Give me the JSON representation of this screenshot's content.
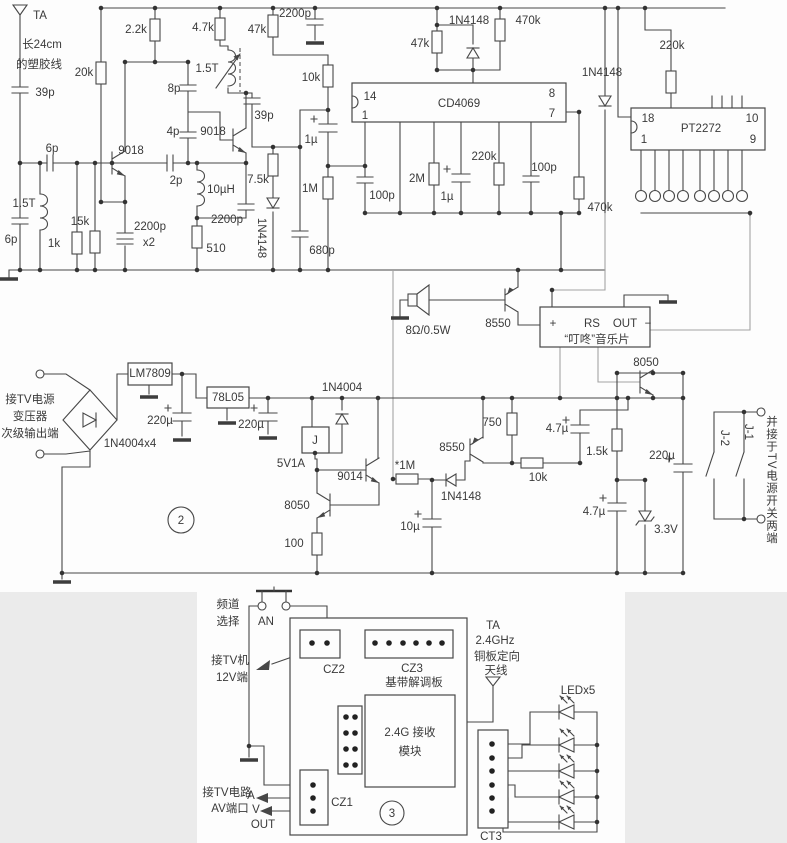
{
  "meta": {
    "accent_line_color": "#474747",
    "light_wire_color": "#a3a3a3",
    "background": "#fdfdfd"
  },
  "sections": {
    "power_section_number": "2",
    "receiver_board_number": "3"
  },
  "labels": [
    {
      "n": "antenna-ta-label",
      "t": "TA",
      "x": 40,
      "y": 16
    },
    {
      "n": "antenna-note-1",
      "t": "长24cm",
      "x": 42,
      "y": 45
    },
    {
      "n": "antenna-note-2",
      "t": "的塑胶线",
      "x": 39,
      "y": 65
    },
    {
      "n": "c-39p-1",
      "t": "39p",
      "x": 45,
      "y": 93
    },
    {
      "n": "c-6p-1",
      "t": "6p",
      "x": 52,
      "y": 149
    },
    {
      "n": "l-1t5-1",
      "t": "1.5T",
      "x": 24,
      "y": 204
    },
    {
      "n": "c-6p-2",
      "t": "6p",
      "x": 11,
      "y": 240,
      "s": 10.5
    },
    {
      "n": "r-1k",
      "t": "1k",
      "x": 54,
      "y": 244
    },
    {
      "n": "r-15k",
      "t": "15k",
      "x": 80,
      "y": 222
    },
    {
      "n": "r-20k",
      "t": "20k",
      "x": 84,
      "y": 73
    },
    {
      "n": "q-9018-1",
      "t": "9018",
      "x": 131,
      "y": 151
    },
    {
      "n": "r-2k2",
      "t": "2.2k",
      "x": 136,
      "y": 30
    },
    {
      "n": "c-2200p-x2",
      "t": "2200p",
      "x": 150,
      "y": 227
    },
    {
      "n": "c-2200p-x2b",
      "t": "x2",
      "x": 149,
      "y": 243
    },
    {
      "n": "c-2p",
      "t": "2p",
      "x": 176,
      "y": 181
    },
    {
      "n": "c-8p",
      "t": "8p",
      "x": 174,
      "y": 89
    },
    {
      "n": "c-4p",
      "t": "4p",
      "x": 173,
      "y": 132
    },
    {
      "n": "l-1t5-2",
      "t": "1.5T",
      "x": 207,
      "y": 69
    },
    {
      "n": "q-9018-2",
      "t": "9018",
      "x": 213,
      "y": 132
    },
    {
      "n": "c-39p-2",
      "t": "39p",
      "x": 264,
      "y": 116
    },
    {
      "n": "l-10uh",
      "t": "10µH",
      "x": 221,
      "y": 190
    },
    {
      "n": "c-2200p-2",
      "t": "2200p",
      "x": 227,
      "y": 220
    },
    {
      "n": "r-510",
      "t": "510",
      "x": 216,
      "y": 249
    },
    {
      "n": "r-7k5",
      "t": "7.5k",
      "x": 258,
      "y": 180
    },
    {
      "n": "d-1n4148-1",
      "t": "1N4148",
      "x": 261,
      "y": 238,
      "r": 90
    },
    {
      "n": "r-4k7",
      "t": "4.7k",
      "x": 203,
      "y": 28
    },
    {
      "n": "r-47k-1",
      "t": "47k",
      "x": 257,
      "y": 30
    },
    {
      "n": "c-2200p-top",
      "t": "2200p",
      "x": 295,
      "y": 14
    },
    {
      "n": "r-10k-1",
      "t": "10k",
      "x": 311,
      "y": 78
    },
    {
      "n": "c-1u-1",
      "t": "1µ",
      "x": 311,
      "y": 140
    },
    {
      "n": "r-1m",
      "t": "1M",
      "x": 310,
      "y": 189
    },
    {
      "n": "c-680p",
      "t": "680p",
      "x": 322,
      "y": 251
    },
    {
      "n": "pin-14",
      "t": "14",
      "x": 370,
      "y": 97,
      "s": 11
    },
    {
      "n": "pin-1",
      "t": "1",
      "x": 365,
      "y": 116,
      "s": 11
    },
    {
      "n": "ic-cd4069",
      "t": "CD4069",
      "x": 459,
      "y": 104
    },
    {
      "n": "pin-8",
      "t": "8",
      "x": 552,
      "y": 94,
      "s": 11
    },
    {
      "n": "pin-7",
      "t": "7",
      "x": 552,
      "y": 114,
      "s": 11
    },
    {
      "n": "r-47k-2",
      "t": "47k",
      "x": 420,
      "y": 44
    },
    {
      "n": "d-1n4148-2",
      "t": "1N4148",
      "x": 469,
      "y": 21
    },
    {
      "n": "r-470k-1",
      "t": "470k",
      "x": 528,
      "y": 21
    },
    {
      "n": "c-100p-1",
      "t": "100p",
      "x": 382,
      "y": 196
    },
    {
      "n": "r-2m",
      "t": "2M",
      "x": 417,
      "y": 179
    },
    {
      "n": "c-1u-2",
      "t": "1µ",
      "x": 447,
      "y": 197
    },
    {
      "n": "r-220k-1",
      "t": "220k",
      "x": 484,
      "y": 157
    },
    {
      "n": "c-100p-2",
      "t": "100p",
      "x": 544,
      "y": 168
    },
    {
      "n": "r-470k-2",
      "t": "470k",
      "x": 600,
      "y": 208
    },
    {
      "n": "d-1n4148-3",
      "t": "1N4148",
      "x": 602,
      "y": 73
    },
    {
      "n": "r-220k-2",
      "t": "220k",
      "x": 672,
      "y": 46
    },
    {
      "n": "pin-18",
      "t": "18",
      "x": 648,
      "y": 119,
      "s": 11
    },
    {
      "n": "pin-1b",
      "t": "1",
      "x": 644,
      "y": 140,
      "s": 11
    },
    {
      "n": "ic-pt2272",
      "t": "PT2272",
      "x": 701,
      "y": 129
    },
    {
      "n": "pin-10",
      "t": "10",
      "x": 752,
      "y": 119,
      "s": 11
    },
    {
      "n": "pin-9",
      "t": "9",
      "x": 753,
      "y": 140,
      "s": 11
    },
    {
      "n": "speaker-spec",
      "t": "8Ω/0.5W",
      "x": 428,
      "y": 331
    },
    {
      "n": "q-8550-mid",
      "t": "8550",
      "x": 498,
      "y": 324
    },
    {
      "n": "music-plus",
      "t": "+",
      "x": 553,
      "y": 324
    },
    {
      "n": "music-rs",
      "t": "RS",
      "x": 592,
      "y": 324
    },
    {
      "n": "music-out",
      "t": "OUT",
      "x": 625,
      "y": 324
    },
    {
      "n": "music-minus",
      "t": "−",
      "x": 648,
      "y": 324
    },
    {
      "n": "music-name",
      "t": "“叮咚”音乐片",
      "x": 597,
      "y": 340
    },
    {
      "n": "q-8050-right",
      "t": "8050",
      "x": 646,
      "y": 363
    },
    {
      "n": "tv-in-1",
      "t": "接TV电源",
      "x": 30,
      "y": 400
    },
    {
      "n": "tv-in-2",
      "t": "变压器",
      "x": 30,
      "y": 417
    },
    {
      "n": "tv-in-3",
      "t": "次级输出端",
      "x": 30,
      "y": 434
    },
    {
      "n": "d-bridge",
      "t": "1N4004x4",
      "x": 130,
      "y": 444
    },
    {
      "n": "ic-lm7809",
      "t": "LM7809",
      "x": 150,
      "y": 374
    },
    {
      "n": "c-220u-1",
      "t": "220µ",
      "x": 160,
      "y": 421
    },
    {
      "n": "ic-78l05",
      "t": "78L05",
      "x": 228,
      "y": 398
    },
    {
      "n": "c-220u-2",
      "t": "220µ",
      "x": 251,
      "y": 425
    },
    {
      "n": "d-1n4004",
      "t": "1N4004",
      "x": 342,
      "y": 388
    },
    {
      "n": "relay-j",
      "t": "J",
      "x": 315,
      "y": 441
    },
    {
      "n": "relay-spec",
      "t": "5V1A",
      "x": 291,
      "y": 464
    },
    {
      "n": "q-9014",
      "t": "9014",
      "x": 350,
      "y": 477
    },
    {
      "n": "r-1m-star",
      "t": "*1M",
      "x": 405,
      "y": 466
    },
    {
      "n": "q-8550-2",
      "t": "8550",
      "x": 452,
      "y": 448
    },
    {
      "n": "d-1n4148-4",
      "t": "1N4148",
      "x": 461,
      "y": 497
    },
    {
      "n": "r-750",
      "t": "750",
      "x": 492,
      "y": 423
    },
    {
      "n": "r-10k-2",
      "t": "10k",
      "x": 538,
      "y": 478
    },
    {
      "n": "c-4u7-1",
      "t": "4.7µ",
      "x": 557,
      "y": 429
    },
    {
      "n": "q-8050-left",
      "t": "8050",
      "x": 297,
      "y": 506
    },
    {
      "n": "r-100",
      "t": "100",
      "x": 294,
      "y": 544
    },
    {
      "n": "c-10u",
      "t": "10µ",
      "x": 410,
      "y": 527
    },
    {
      "n": "r-1k5",
      "t": "1.5k",
      "x": 597,
      "y": 452
    },
    {
      "n": "c-220u-3",
      "t": "220µ",
      "x": 662,
      "y": 456
    },
    {
      "n": "c-4u7-2",
      "t": "4.7µ",
      "x": 594,
      "y": 512
    },
    {
      "n": "d-zener",
      "t": "3.3V",
      "x": 666,
      "y": 530
    },
    {
      "n": "contact-j1",
      "t": "J-1",
      "x": 748,
      "y": 432,
      "r": 90
    },
    {
      "n": "contact-j2",
      "t": "J-2",
      "x": 724,
      "y": 438,
      "r": 90
    },
    {
      "n": "note-parallel-switch",
      "t": "并接于TV电源开关两端",
      "x": 771,
      "y": 480,
      "v": true
    },
    {
      "n": "section-2",
      "t": "2",
      "x": 181,
      "y": 521,
      "s": 15
    },
    {
      "n": "channel-1",
      "t": "频道",
      "x": 228,
      "y": 605
    },
    {
      "n": "channel-2",
      "t": "选择",
      "x": 228,
      "y": 622
    },
    {
      "n": "button-an",
      "t": "AN",
      "x": 266,
      "y": 622
    },
    {
      "n": "conn-cz2",
      "t": "CZ2",
      "x": 334,
      "y": 670
    },
    {
      "n": "conn-cz3",
      "t": "CZ3",
      "x": 412,
      "y": 669
    },
    {
      "n": "board-name",
      "t": "基带解调板",
      "x": 414,
      "y": 683
    },
    {
      "n": "tv12v-1",
      "t": "接TV机",
      "x": 230,
      "y": 661
    },
    {
      "n": "tv12v-2",
      "t": "12V端",
      "x": 232,
      "y": 678
    },
    {
      "n": "ant3-ta",
      "t": "TA",
      "x": 493,
      "y": 626
    },
    {
      "n": "ant3-freq",
      "t": "2.4GHz",
      "x": 495,
      "y": 641
    },
    {
      "n": "ant3-type",
      "t": "铜板定向",
      "x": 497,
      "y": 657
    },
    {
      "n": "ant3-name",
      "t": "天线",
      "x": 496,
      "y": 671
    },
    {
      "n": "module-1",
      "t": "2.4G 接收",
      "x": 410,
      "y": 733
    },
    {
      "n": "module-2",
      "t": "模块",
      "x": 410,
      "y": 752
    },
    {
      "n": "conn-cz1",
      "t": "CZ1",
      "x": 342,
      "y": 803
    },
    {
      "n": "av-1",
      "t": "接TV电路",
      "x": 227,
      "y": 793
    },
    {
      "n": "av-2",
      "t": "AV端口",
      "x": 230,
      "y": 809
    },
    {
      "n": "av-a",
      "t": "A",
      "x": 251,
      "y": 796,
      "s": 11
    },
    {
      "n": "av-v",
      "t": "V",
      "x": 256,
      "y": 810,
      "s": 11
    },
    {
      "n": "av-out",
      "t": "OUT",
      "x": 263,
      "y": 825,
      "s": 11
    },
    {
      "n": "section-3",
      "t": "3",
      "x": 392,
      "y": 814,
      "s": 15
    },
    {
      "n": "led-count",
      "t": "LEDx5",
      "x": 578,
      "y": 691
    },
    {
      "n": "conn-ct3",
      "t": "CT3",
      "x": 491,
      "y": 837
    }
  ]
}
